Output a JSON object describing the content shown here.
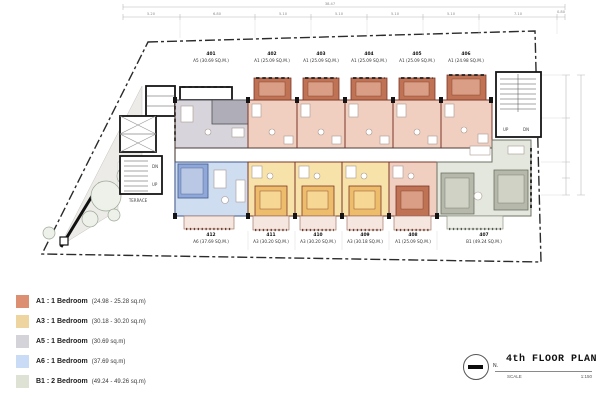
{
  "plan": {
    "title": "4th FLOOR PLAN",
    "north_label": "N.",
    "scale_label": "SCALE",
    "scale_value": "1:150",
    "terrace_label": "TERRACE",
    "stair_left": {
      "down": "DN",
      "up": "UP"
    },
    "stair_right": {
      "up": "UP",
      "down": "DN"
    },
    "dimensions": {
      "total": "38.47",
      "segments": [
        "5.20",
        "6.80",
        "5.10",
        "5.10",
        "5.10",
        "5.10",
        "7.10",
        "0.80"
      ]
    },
    "units_top": [
      {
        "number": "401",
        "label": "A5 (30.69 SQ.M.)"
      },
      {
        "number": "402",
        "label": "A1 (25.09 SQ.M.)"
      },
      {
        "number": "403",
        "label": "A1 (25.09 SQ.M.)"
      },
      {
        "number": "404",
        "label": "A1 (25.09 SQ.M.)"
      },
      {
        "number": "405",
        "label": "A1 (25.09 SQ.M.)"
      },
      {
        "number": "406",
        "label": "A1 (24.98 SQ.M.)"
      }
    ],
    "units_bottom": [
      {
        "number": "412",
        "label": "A6 (37.69 SQ.M.)"
      },
      {
        "number": "411",
        "label": "A3 (30.20 SQ.M.)"
      },
      {
        "number": "410",
        "label": "A3 (30.20 SQ.M.)"
      },
      {
        "number": "409",
        "label": "A3 (30.18 SQ.M.)"
      },
      {
        "number": "408",
        "label": "A1 (25.09 SQ.M.)"
      },
      {
        "number": "407",
        "label": "B1 (49.24 SQ.M.)"
      }
    ]
  },
  "legend": {
    "items": [
      {
        "label": "A1 : 1 Bedroom",
        "area": "(24.98 - 25.28 sq.m)",
        "color": "#dd8f72"
      },
      {
        "label": "A3 : 1 Bedroom",
        "area": "(30.18 - 30.20 sq.m)",
        "color": "#eed49e"
      },
      {
        "label": "A5 : 1 Bedroom",
        "area": "(30.69 sq.m)",
        "color": "#d4d3d9"
      },
      {
        "label": "A6 : 1 Bedroom",
        "area": "(37.69 sq.m)",
        "color": "#c9dbf5"
      },
      {
        "label": "B1 : 2 Bedroom",
        "area": "(49.24 - 49.26 sq.m)",
        "color": "#dde2d4"
      }
    ]
  },
  "colors": {
    "a1_body": "#f1cfc0",
    "a1_dark": "#bf7254",
    "a1_inner": "#d99e85",
    "wall_red": "#7c3526",
    "a3_body": "#f7e3aa",
    "a3_dark": "#edbd6b",
    "a3_inner": "#f6d793",
    "a5_body": "#d7d5db",
    "a5_dark": "#afadb7",
    "a6_body": "#cfddf1",
    "a6_dark": "#8fa8d8",
    "a6_inner": "#bac8e6",
    "b1_body": "#e4e7dd",
    "b1_dark": "#b5b8ab",
    "b1_inner": "#cfd2c5",
    "balcony": "#f5e7df"
  }
}
